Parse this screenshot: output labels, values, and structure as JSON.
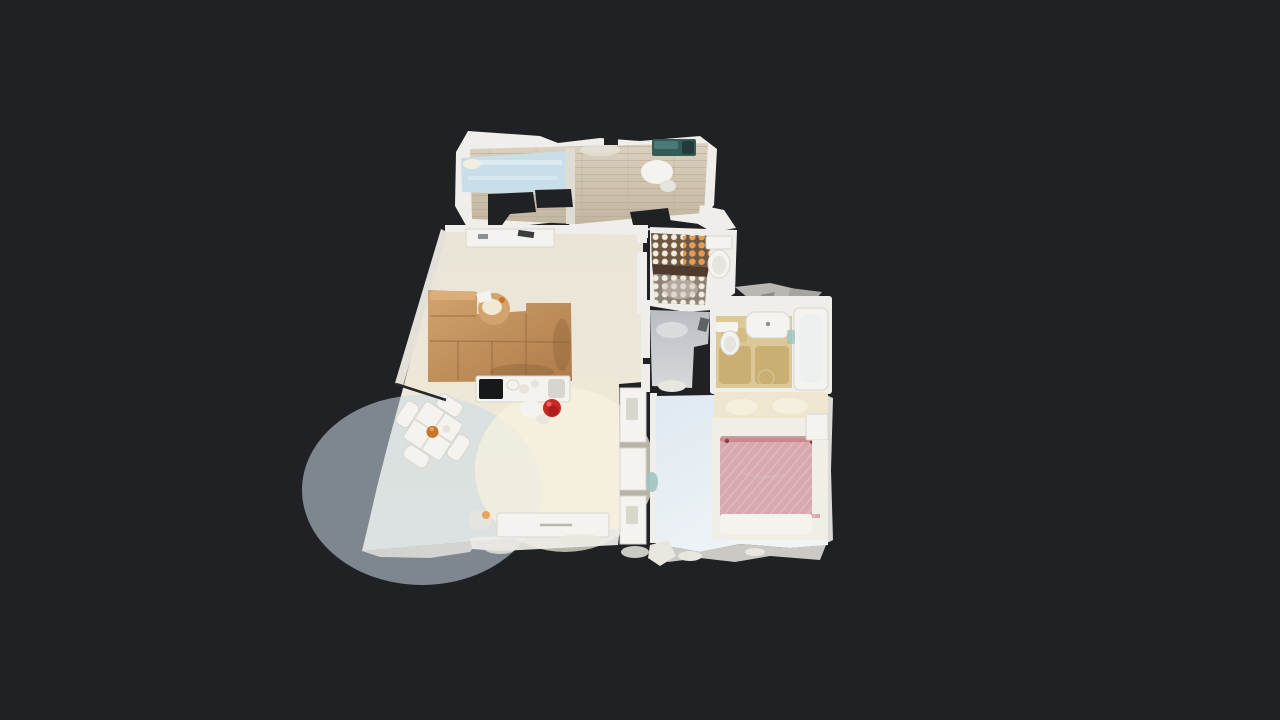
{
  "canvas": {
    "width": 1280,
    "height": 720
  },
  "scene": {
    "view": "top-down-3d-dollhouse-floorplan-scan",
    "rooms": {
      "balcony": "balcony-terrace",
      "living": "living-dining-room",
      "bath1": "mosaic-tile-bathroom-with-shower",
      "hall": "entry-hall",
      "bath2": "beige-bathroom-with-tub",
      "bedroom": "bedroom-with-pink-bed"
    },
    "furniture": {
      "sofa": "u-shaped-sectional-sofa",
      "coffee_table": "round-wicker-coffee-table",
      "dining": "square-dining-table-with-four-chairs",
      "counter": "kitchen-counter-with-black-cooktop",
      "stool": "red-round-stool",
      "sideboard": "white-sideboard",
      "daybed": "light-blue-daybed",
      "toilet1": "toilet",
      "toilet2": "toilet",
      "sink": "washbasin",
      "tub": "bathtub",
      "bed": "double-bed-pink-duvet",
      "nightstand": "nightstand"
    }
  },
  "colors": {
    "background": "#1f2124",
    "wall": "#efeeea",
    "wall_shade": "#dddad2",
    "wood_a": "#dbd1bf",
    "wood_b": "#c3b6a0",
    "plank": "#b4a791",
    "daybed": "#c8dfe9",
    "daybed_hi": "#e0eef4",
    "divider": "#dfdcd4",
    "teal_a": "#335c58",
    "teal_b": "#4a7a74",
    "teal_c": "#223b39",
    "living_a": "#eae5d7",
    "living_b": "#f0ead9",
    "cool_patch": "#ccdbe8",
    "warm_patch": "#f8f2df",
    "leftwall": "#e3e0da",
    "sofa_a": "#d2a46d",
    "sofa_b": "#ad7b4a",
    "sofa_hi": "#ddb27e",
    "sofa_blotch": "#7e5530",
    "fixture": "#f4f3ef",
    "fixture_inner": "#e6e4de",
    "table_cross": "#e0dcd2",
    "bowl": "#c8762c",
    "bowl_hi": "#e8a45a",
    "plate": "#e8e4da",
    "cooktop": "#17181a",
    "sink_gray": "#d7d5cf",
    "stool_red": "#cb2823",
    "stool_red_dark": "#a81d1c",
    "stool_red_hi": "#e8655e",
    "handle": "#b9b5ac",
    "shelf_item_dark": "#3a3d40",
    "shelf_item_gray": "#8b8f93",
    "tile_brown": "#6e5743",
    "tile_band": "#4e3b2d",
    "shower_base": "#8d8478",
    "shower_shine": "#cfc9bd",
    "dot_white": "#f3ecdc",
    "dot_orange": "#e59a4e",
    "hall_a": "#b9bdc2",
    "hall_b": "#d7d9db",
    "hall_shine": "#e4e6e8",
    "hall_item": "#5f6265",
    "bath2_floor": "#dcc897",
    "bath2_mat": "#c9b072",
    "bath2_mat2": "#d2bc82",
    "tub_inner": "#ecf0ef",
    "teal_glass": "#9fc4c2",
    "fragment_a": "#b9b7b2",
    "fragment_b": "#a7a5a0",
    "fragment_c": "#8f8d89",
    "bed_floor_a": "#dfe9f0",
    "bed_floor_b": "#f0f4f7",
    "headboard": "#eee6cf",
    "pillow": "#f5efde",
    "frame": "#f1eee7",
    "duvet": "#d9a9b0",
    "duvet_stripe": "#e6c0c5",
    "duvet_rumple": "#c08083",
    "duvet_accent": "#8e3f3c",
    "sheet": "#f5f3ee",
    "noise": "#e9e6df",
    "scan_dark": "#26282a",
    "closet_detail": "#d9d6ce"
  }
}
